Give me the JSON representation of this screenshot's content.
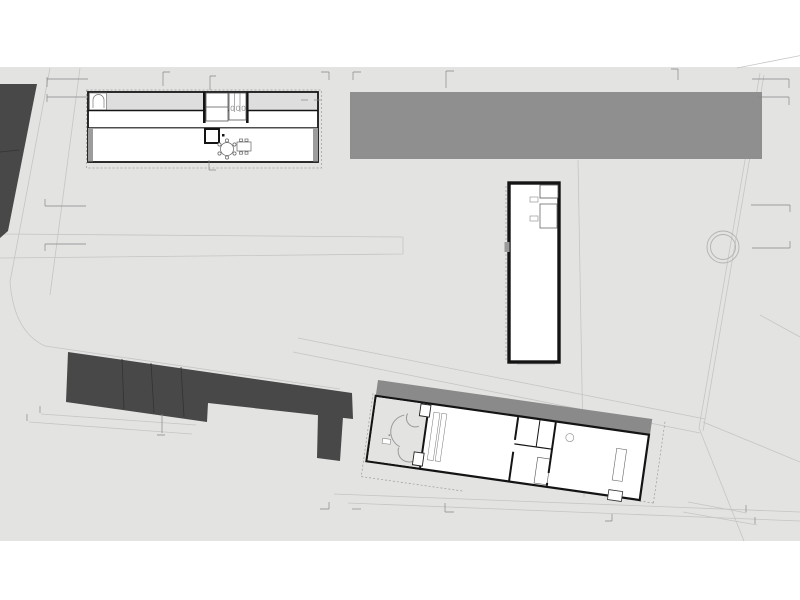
{
  "markers": {
    "a_top_left": "A",
    "b_top_left": "B",
    "g_top": "G",
    "a_small_top": "a",
    "k_top": "K",
    "h_top": "H",
    "i_top": "I",
    "j_top": "J",
    "a_top_right": "A",
    "b_top_right": "B",
    "c_left": "C",
    "f_left": "F",
    "c_right": "C",
    "f_right": "F",
    "e_left": "E",
    "d_left": "D",
    "g_bottom": "G",
    "k_bottom": "K",
    "h_bottom": "H",
    "i_bottom": "I",
    "j_bottom": "J",
    "e_bottom_right": "E",
    "d_bottom_right": "D",
    "a_small_bottom": "a",
    "b_small_inner": "b",
    "b_small_outer": "b"
  },
  "colors": {
    "page": "#ffffff",
    "site": "#e3e3e2",
    "site_line": "#c5c5c5",
    "dark_building": "#484848",
    "roof_gray": "#8f8f8f",
    "canopy_gray": "#8a8a8a",
    "wall": "#141414",
    "tree": "#b2b2b2",
    "dashed_outline": "#9b9b9b"
  }
}
